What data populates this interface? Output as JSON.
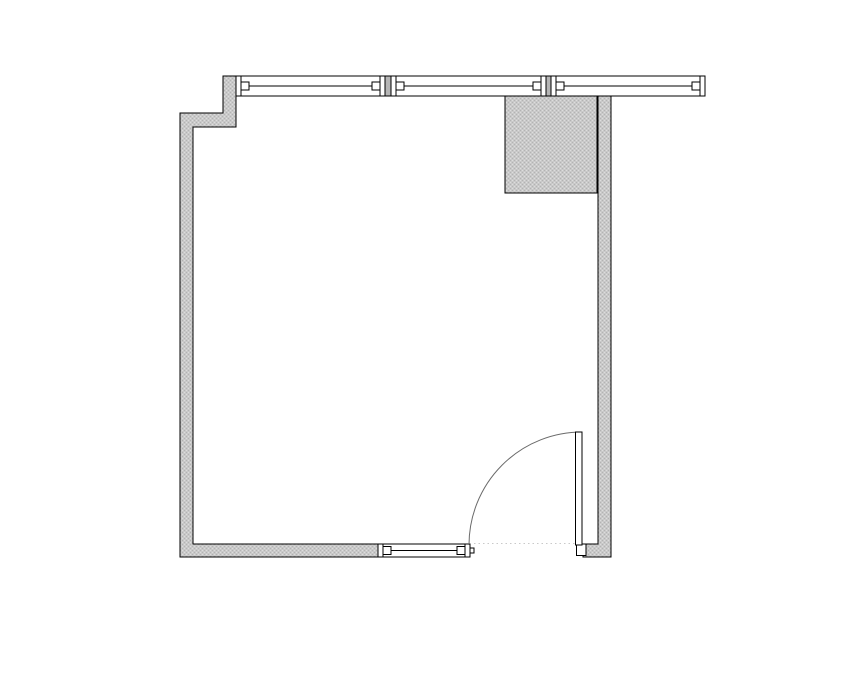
{
  "title": "room-floor-plan",
  "canvas": {
    "width": 855,
    "height": 678,
    "background": "#ffffff"
  },
  "colors": {
    "line": "#000000",
    "wall_fill_base": "#c9c9c9",
    "wall_fill_light": "#dddddd",
    "wall_fill_dark": "#b3b3b3",
    "mullion_fill": "#b5b5b5",
    "glass_fill": "#ffffff",
    "swing_arc": "#6a6a6a",
    "threshold": "#c9c9c9"
  },
  "primitives": [
    {
      "kind": "polygon",
      "name": "wall-left-and-bottom",
      "fill": "wall",
      "stroke": "line",
      "points": "236,76 236,127 193,127 193,544 378,544 378,557 180,557 180,113 223,113 223,76"
    },
    {
      "kind": "polygon",
      "name": "wall-right",
      "fill": "wall",
      "stroke": "line",
      "points": "598,96 598,544 583,544 583,557 611,557 611,96"
    },
    {
      "kind": "rect",
      "name": "shaft-column-block",
      "fill": "wall",
      "stroke": "line",
      "x": 505,
      "y": 96,
      "w": 92,
      "h": 97
    },
    {
      "kind": "rect",
      "name": "curtain-window-segment-1-frame",
      "fill": "white",
      "stroke": "line",
      "x": 236,
      "y": 76,
      "w": 149,
      "h": 20
    },
    {
      "kind": "line",
      "name": "curtain-window-segment-1-cap-left",
      "stroke": "line",
      "x1": 241,
      "y1": 76,
      "x2": 241,
      "y2": 96
    },
    {
      "kind": "line",
      "name": "curtain-window-segment-1-cap-right",
      "stroke": "line",
      "x1": 380,
      "y1": 76,
      "x2": 380,
      "y2": 96
    },
    {
      "kind": "rect",
      "name": "curtain-window-segment-1-stop-left",
      "fill": "white",
      "stroke": "line",
      "x": 241,
      "y": 82,
      "w": 8,
      "h": 8
    },
    {
      "kind": "rect",
      "name": "curtain-window-segment-1-stop-right",
      "fill": "white",
      "stroke": "line",
      "x": 372,
      "y": 82,
      "w": 8,
      "h": 8
    },
    {
      "kind": "line",
      "name": "curtain-window-segment-1-glass",
      "stroke": "line",
      "x1": 249,
      "y1": 86,
      "x2": 372,
      "y2": 86
    },
    {
      "kind": "rect",
      "name": "window-mullion-1",
      "fill": "mullion",
      "stroke": "line",
      "x": 385,
      "y": 76,
      "w": 6,
      "h": 20
    },
    {
      "kind": "rect",
      "name": "curtain-window-segment-2-frame",
      "fill": "white",
      "stroke": "line",
      "x": 391,
      "y": 76,
      "w": 155,
      "h": 20
    },
    {
      "kind": "line",
      "name": "curtain-window-segment-2-cap-left",
      "stroke": "line",
      "x1": 396,
      "y1": 76,
      "x2": 396,
      "y2": 96
    },
    {
      "kind": "line",
      "name": "curtain-window-segment-2-cap-right",
      "stroke": "line",
      "x1": 541,
      "y1": 76,
      "x2": 541,
      "y2": 96
    },
    {
      "kind": "rect",
      "name": "curtain-window-segment-2-stop-left",
      "fill": "white",
      "stroke": "line",
      "x": 396,
      "y": 82,
      "w": 8,
      "h": 8
    },
    {
      "kind": "rect",
      "name": "curtain-window-segment-2-stop-right",
      "fill": "white",
      "stroke": "line",
      "x": 533,
      "y": 82,
      "w": 8,
      "h": 8
    },
    {
      "kind": "line",
      "name": "curtain-window-segment-2-glass",
      "stroke": "line",
      "x1": 404,
      "y1": 86,
      "x2": 533,
      "y2": 86
    },
    {
      "kind": "rect",
      "name": "window-mullion-2",
      "fill": "mullion",
      "stroke": "line",
      "x": 546,
      "y": 76,
      "w": 5,
      "h": 20
    },
    {
      "kind": "rect",
      "name": "curtain-window-segment-3-frame",
      "fill": "white",
      "stroke": "line",
      "x": 551,
      "y": 76,
      "w": 154,
      "h": 20
    },
    {
      "kind": "line",
      "name": "curtain-window-segment-3-cap-left",
      "stroke": "line",
      "x1": 556,
      "y1": 76,
      "x2": 556,
      "y2": 96
    },
    {
      "kind": "line",
      "name": "curtain-window-segment-3-cap-right",
      "stroke": "line",
      "x1": 700,
      "y1": 76,
      "x2": 700,
      "y2": 96
    },
    {
      "kind": "rect",
      "name": "curtain-window-segment-3-stop-left",
      "fill": "white",
      "stroke": "line",
      "x": 556,
      "y": 82,
      "w": 8,
      "h": 8
    },
    {
      "kind": "rect",
      "name": "curtain-window-segment-3-stop-right",
      "fill": "white",
      "stroke": "line",
      "x": 692,
      "y": 82,
      "w": 8,
      "h": 8
    },
    {
      "kind": "line",
      "name": "curtain-window-segment-3-glass",
      "stroke": "line",
      "x1": 564,
      "y1": 86,
      "x2": 692,
      "y2": 86
    },
    {
      "kind": "rect",
      "name": "bottom-window-frame",
      "fill": "white",
      "stroke": "line",
      "x": 378,
      "y": 544,
      "w": 92,
      "h": 13
    },
    {
      "kind": "line",
      "name": "bottom-window-cap-left",
      "stroke": "line",
      "x1": 383,
      "y1": 544,
      "x2": 383,
      "y2": 557
    },
    {
      "kind": "line",
      "name": "bottom-window-cap-right",
      "stroke": "line",
      "x1": 465,
      "y1": 544,
      "x2": 465,
      "y2": 557
    },
    {
      "kind": "rect",
      "name": "bottom-window-stop-left",
      "fill": "white",
      "stroke": "line",
      "x": 383,
      "y": 546.5,
      "w": 8,
      "h": 8
    },
    {
      "kind": "rect",
      "name": "bottom-window-stop-right",
      "fill": "white",
      "stroke": "line",
      "x": 457,
      "y": 546.5,
      "w": 8,
      "h": 8
    },
    {
      "kind": "line",
      "name": "bottom-window-glass",
      "stroke": "line",
      "x1": 391,
      "y1": 550.5,
      "x2": 457,
      "y2": 550.5
    },
    {
      "kind": "rect",
      "name": "bottom-window-end-nub",
      "fill": "white",
      "stroke": "line",
      "x": 470,
      "y": 548,
      "w": 4,
      "h": 5
    },
    {
      "kind": "line",
      "name": "door-threshold-dotted-line",
      "stroke": "threshold",
      "dash": "1.5 3",
      "x1": 474,
      "y1": 543.5,
      "x2": 576,
      "y2": 543.5
    },
    {
      "kind": "path",
      "name": "door-swing-arc",
      "fill": "none",
      "stroke": "swing",
      "smooth": true,
      "d": "M 582 432 A 113 113 0 0 0 469 545"
    },
    {
      "kind": "rect",
      "name": "door-jamb-block",
      "fill": "white",
      "stroke": "line",
      "x": 576.5,
      "y": 544,
      "w": 9.5,
      "h": 11.5
    },
    {
      "kind": "rect",
      "name": "door-leaf",
      "fill": "white",
      "stroke": "line",
      "x": 575.5,
      "y": 432,
      "w": 6.5,
      "h": 113
    }
  ]
}
